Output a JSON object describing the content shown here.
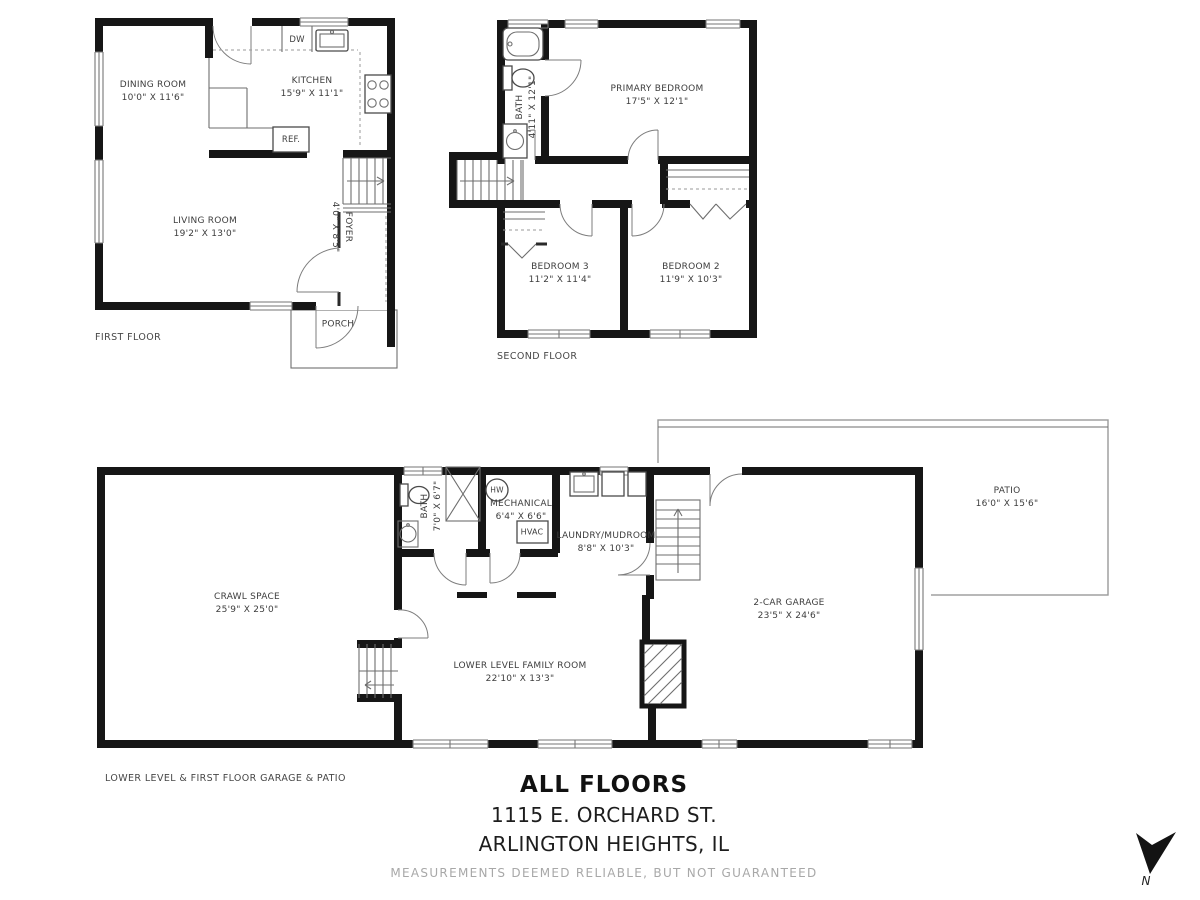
{
  "page": {
    "title": "ALL FLOORS",
    "address_line1": "1115 E. ORCHARD ST.",
    "address_line2": "ARLINGTON HEIGHTS, IL",
    "disclaimer": "MEASUREMENTS DEEMED RELIABLE, BUT NOT GUARANTEED",
    "north_label": "N"
  },
  "floors": {
    "first": {
      "caption": "FIRST FLOOR",
      "rooms": {
        "dining": {
          "name": "DINING ROOM",
          "dims": "10'0\" X 11'6\""
        },
        "kitchen": {
          "name": "KITCHEN",
          "dims": "15'9\" X 11'1\""
        },
        "living": {
          "name": "LIVING ROOM",
          "dims": "19'2\" X 13'0\""
        },
        "foyer": {
          "name": "FOYER",
          "dims": "4'0\" X 8'5\""
        },
        "porch": {
          "name": "PORCH"
        }
      },
      "fixtures": {
        "dw": "DW",
        "ref": "REF."
      }
    },
    "second": {
      "caption": "SECOND FLOOR",
      "rooms": {
        "bath": {
          "name": "BATH",
          "dims": "4'11\" X 12'1\""
        },
        "primary": {
          "name": "PRIMARY BEDROOM",
          "dims": "17'5\" X 12'1\""
        },
        "bedroom3": {
          "name": "BEDROOM 3",
          "dims": "11'2\" X 11'4\""
        },
        "bedroom2": {
          "name": "BEDROOM 2",
          "dims": "11'9\" X 10'3\""
        }
      }
    },
    "lower": {
      "caption": "LOWER LEVEL & FIRST FLOOR GARAGE & PATIO",
      "rooms": {
        "crawl": {
          "name": "CRAWL SPACE",
          "dims": "25'9\" X 25'0\""
        },
        "bath": {
          "name": "BATH",
          "dims": "7'0\" X 6'7\""
        },
        "mechanical": {
          "name": "MECHANICAL",
          "dims": "6'4\" X 6'6\""
        },
        "laundry": {
          "name": "LAUNDRY/MUDROOM",
          "dims": "8'8\" X 10'3\""
        },
        "family": {
          "name": "LOWER LEVEL FAMILY ROOM",
          "dims": "22'10\" X 13'3\""
        },
        "garage": {
          "name": "2-CAR GARAGE",
          "dims": "23'5\" X 24'6\""
        },
        "patio": {
          "name": "PATIO",
          "dims": "16'0\" X 15'6\""
        }
      },
      "fixtures": {
        "hw": "HW",
        "hvac": "HVAC"
      }
    }
  }
}
